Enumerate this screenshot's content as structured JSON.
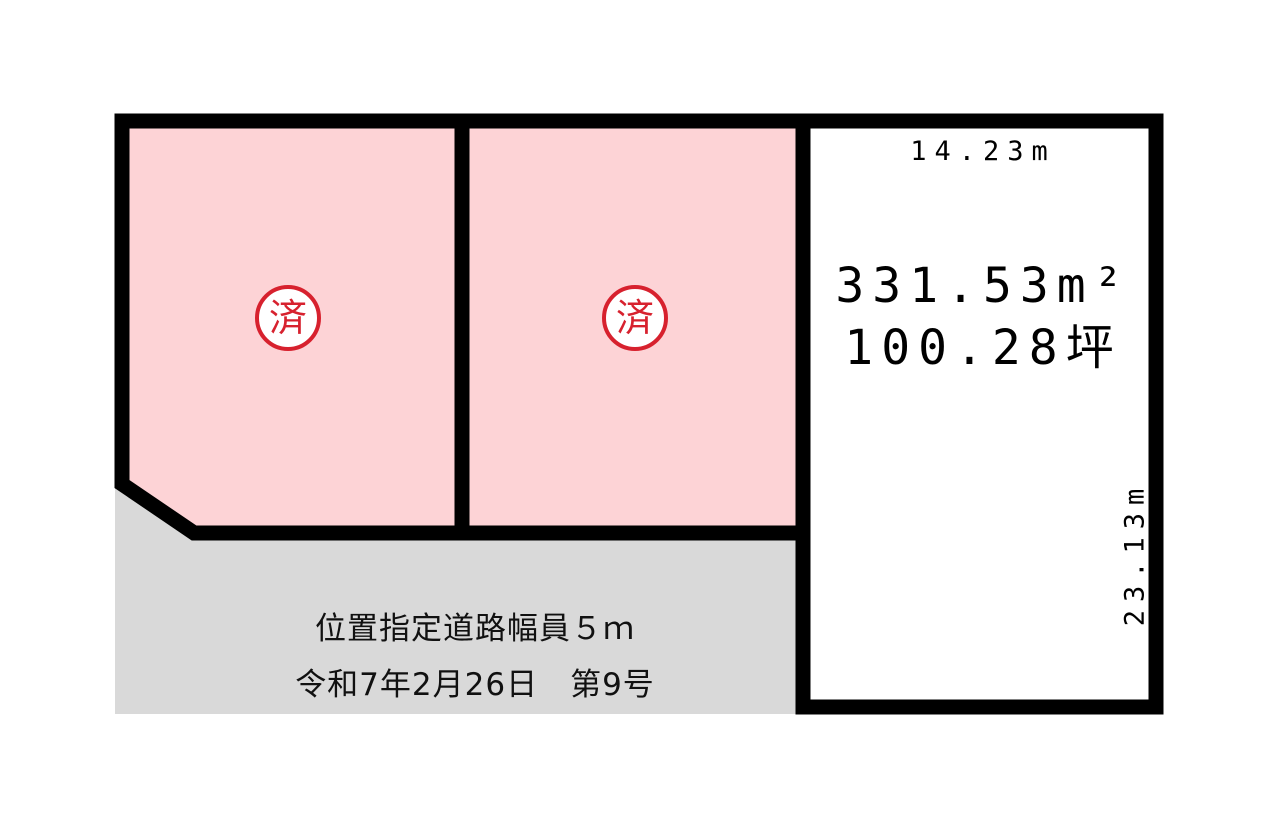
{
  "diagram": {
    "background": "#ffffff",
    "plots": [
      {
        "name": "plot-1",
        "status_stamp": "済",
        "fill": "#fdd3d6"
      },
      {
        "name": "plot-2",
        "status_stamp": "済",
        "fill": "#fdd3d6"
      },
      {
        "name": "plot-3",
        "frontage_label": "14.23m",
        "area_sqm_label": "331.53m²",
        "area_tsubo_label": "100.28坪",
        "depth_label": "23.13m",
        "fill": "#ffffff"
      }
    ],
    "road": {
      "designation_line": "位置指定道路幅員５ｍ",
      "date_number_line": "令和7年2月26日　第9号",
      "fill": "#d9d9d9"
    },
    "colors": {
      "outline": "#000000",
      "stamp_red": "#d7212e",
      "text": "#000000"
    }
  }
}
